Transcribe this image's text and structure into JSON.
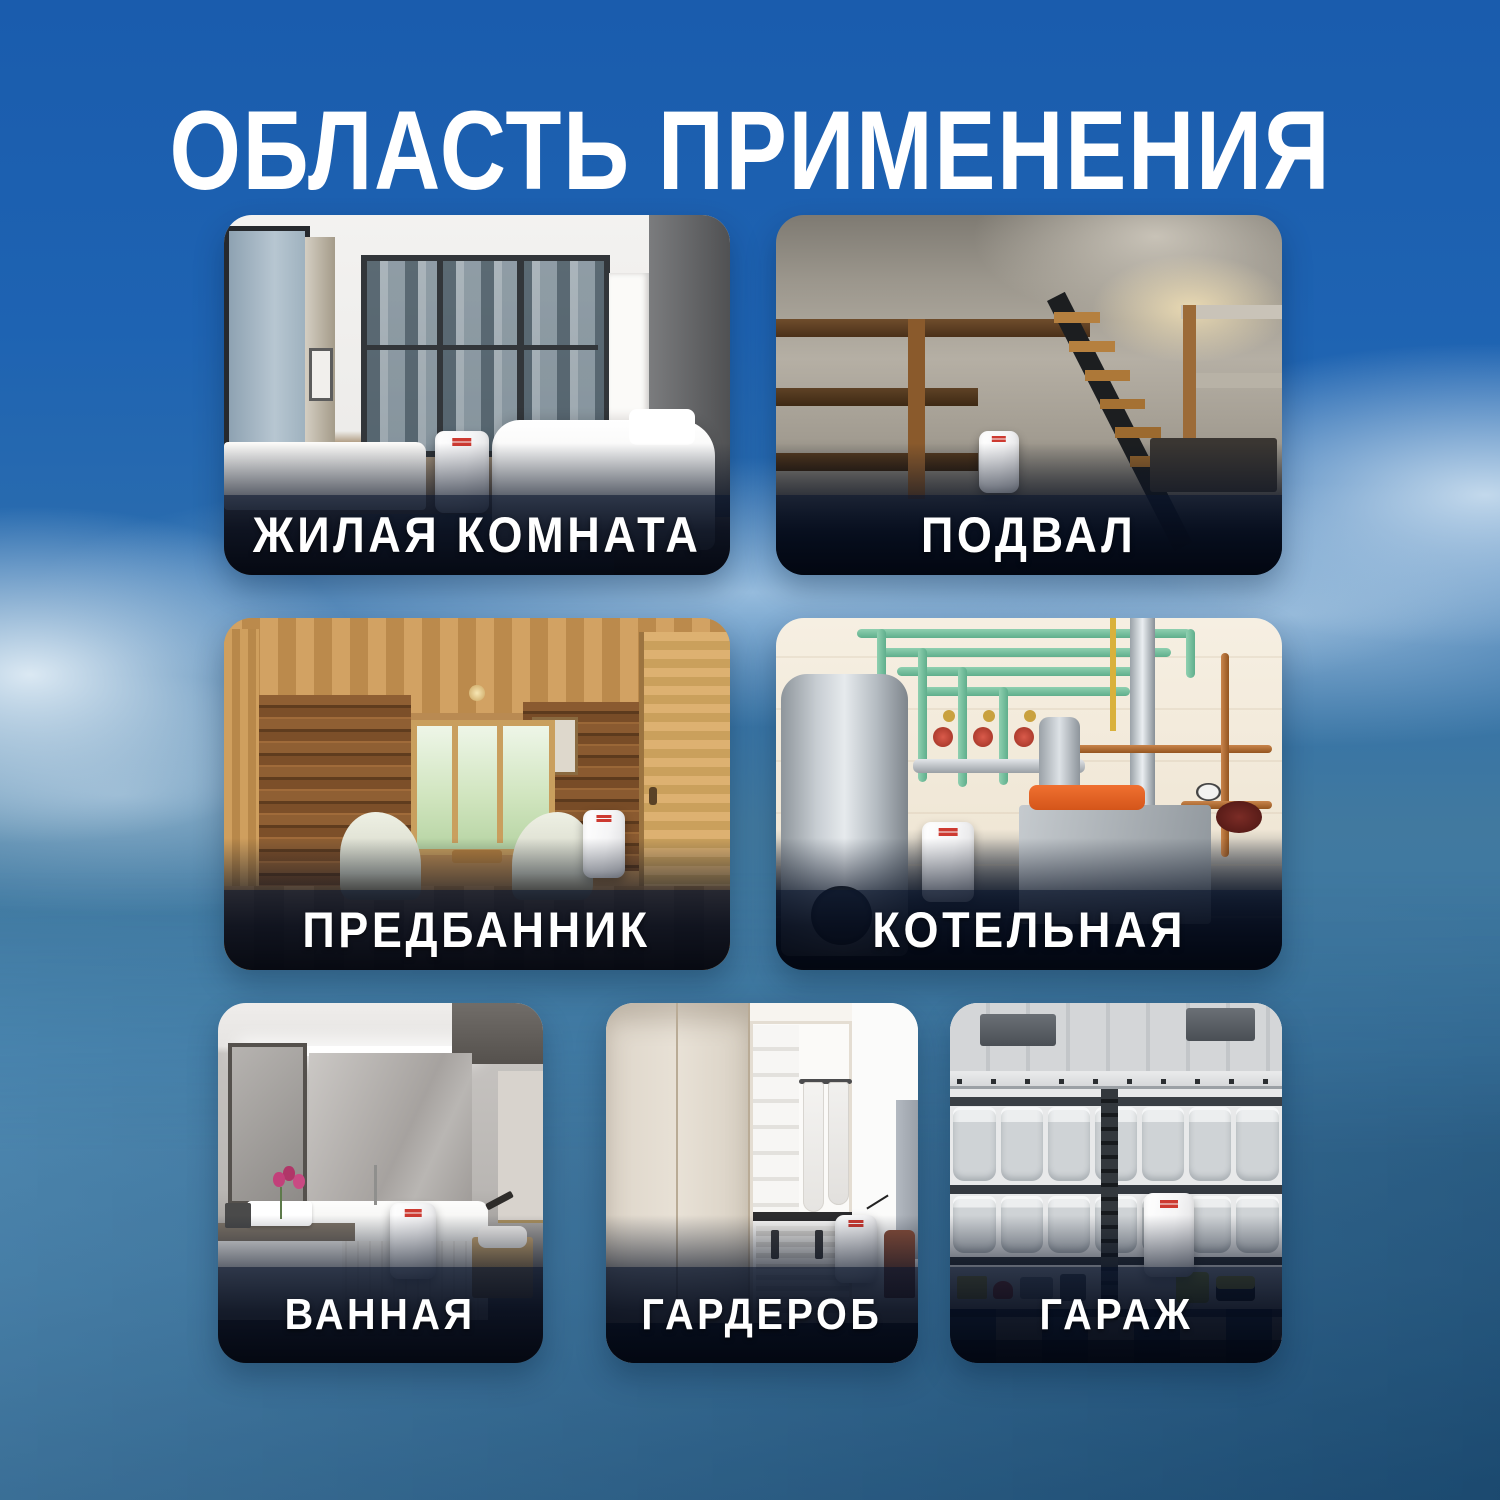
{
  "header": {
    "title": "ОБЛАСТЬ ПРИМЕНЕНИЯ"
  },
  "cards": [
    {
      "label": "ЖИЛАЯ КОМНАТА",
      "alt": "bedroom with city-view windows, white bed and bench, dehumidifier on the floor"
    },
    {
      "label": "ПОДВАЛ",
      "alt": "concrete basement with wooden shelves and staircase, dehumidifier on the floor"
    },
    {
      "label": "ПРЕДБАННИК",
      "alt": "log-cabin anteroom with two light armchairs, table and garden window, dehumidifier by the door"
    },
    {
      "label": "КОТЕЛЬНАЯ",
      "alt": "boiler room with green and copper pipes, steel tank, gray unit with orange top, dehumidifier"
    },
    {
      "label": "ВАННАЯ",
      "alt": "modern bathroom with mirror, vanity, flowers, bathtub and dehumidifier"
    },
    {
      "label": "ГАРДЕРОБ",
      "alt": "walk-in wardrobe with cream panels and hanging clothes, dehumidifier"
    },
    {
      "label": "ГАРАЖ",
      "alt": "garage shelves full of gray storage bins and tools, dehumidifier on checkered floor"
    }
  ],
  "device": {
    "name": "dehumidifier",
    "body_color": "#f5f5f6",
    "logo_color": "#cd3a31"
  },
  "colors": {
    "background_top": "#1a5cad",
    "background_bottom_left": "#4586b3",
    "background_bottom_right": "#245a85",
    "cloud": "#d3e3f1",
    "label_band": "#050d1d",
    "label_text": "#ffffff",
    "title_text": "#ffffff"
  }
}
